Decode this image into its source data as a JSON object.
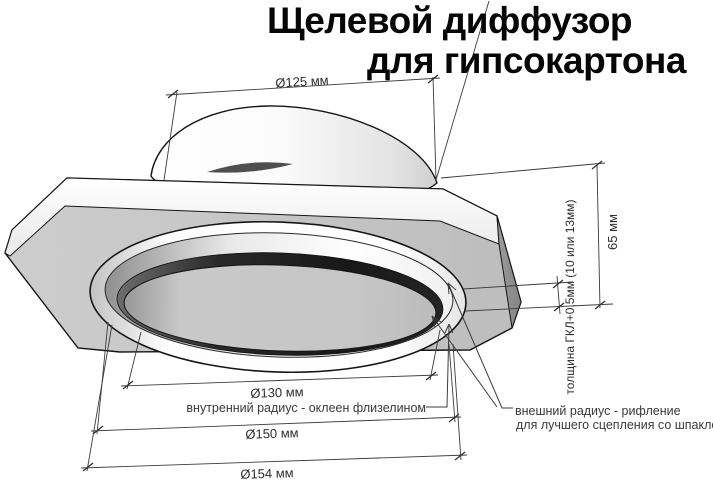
{
  "title": {
    "line1": "Щелевой диффузор",
    "line2": "для гипсокартона"
  },
  "dimensions": {
    "d125": "Ø125 мм",
    "d130": "Ø130 мм",
    "d150": "Ø150 мм",
    "d154": "Ø154 мм",
    "h65": "65 мм",
    "thickness": "толщина ГКЛ+0,5мм (10 или 13мм)"
  },
  "annotations": {
    "inner_radius": "внутренний радиус - оклеен флизелином",
    "outer_radius_line1": "внешний радиус - рифление",
    "outer_radius_line2": "для лучшего сцепления со шпаклёвкой"
  },
  "colors": {
    "background": "#ffffff",
    "outline": "#161616",
    "dimension_line": "#3c3c3c",
    "text": "#2e2e2e",
    "plate_underside": "#c6c6c6",
    "plate_edge_band": "#f7f7f7",
    "plate_corner_facet": "#919191",
    "slot_dark": "#1e1e1e",
    "disc_gray": "#c4c4c4"
  }
}
